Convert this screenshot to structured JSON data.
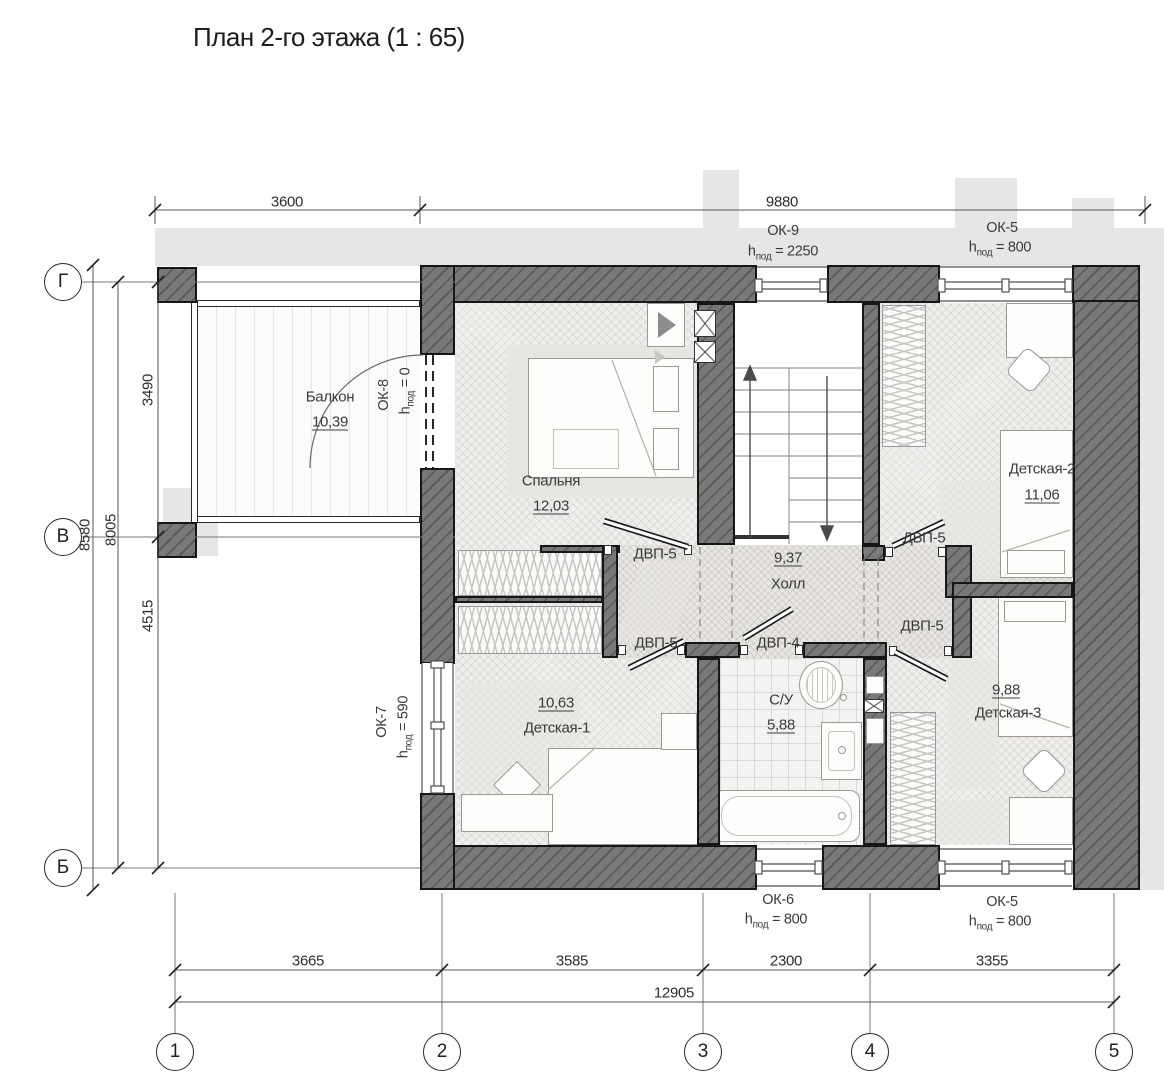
{
  "title": "План 2-го этажа (1 : 65)",
  "colors": {
    "wall": "#787878",
    "wall_line": "#161616",
    "floor": "#efeeec",
    "roof_shadow": "#e6e6e4"
  },
  "axes": {
    "rows": [
      {
        "label": "Г"
      },
      {
        "label": "В"
      },
      {
        "label": "Б"
      }
    ],
    "cols": [
      {
        "label": "1"
      },
      {
        "label": "2"
      },
      {
        "label": "3"
      },
      {
        "label": "4"
      },
      {
        "label": "5"
      }
    ]
  },
  "dims": {
    "top_left": "3600",
    "top_right": "9880",
    "left_outer": "8580",
    "left_inner": "8005",
    "left_upper": "3490",
    "left_lower": "4515",
    "b1": "3665",
    "b2": "3585",
    "b3": "2300",
    "b4": "3355",
    "total": "12905"
  },
  "rooms": [
    {
      "name": "Балкон",
      "area": "10,39"
    },
    {
      "name": "Спальня",
      "area": "12,03"
    },
    {
      "name": "Холл",
      "area": "9,37"
    },
    {
      "name": "Детская-1",
      "area": "10,63"
    },
    {
      "name": "Детская-2",
      "area": "11,06"
    },
    {
      "name": "Детская-3",
      "area": "9,88"
    },
    {
      "name": "С/У",
      "area": "5,88"
    }
  ],
  "windows": [
    {
      "id": "ОК-9",
      "h": "h",
      "sub": "под",
      "val": " = 2250"
    },
    {
      "id": "ОК-5",
      "h": "h",
      "sub": "под",
      "val": " = 800"
    },
    {
      "id": "ОК-6",
      "h": "h",
      "sub": "под",
      "val": " = 800"
    },
    {
      "id": "ОК-5",
      "h": "h",
      "sub": "под",
      "val": " = 800"
    },
    {
      "id": "ОК-7",
      "h": "h",
      "sub": "под",
      "val": " = 590"
    },
    {
      "id": "ОК-8",
      "h": "h",
      "sub": "под",
      "val": " = 0"
    }
  ],
  "doors": [
    {
      "label": "ДВП-5"
    },
    {
      "label": "ДВП-5"
    },
    {
      "label": "ДВП-5"
    },
    {
      "label": "ДВП-4"
    },
    {
      "label": "ДВП-5"
    }
  ]
}
